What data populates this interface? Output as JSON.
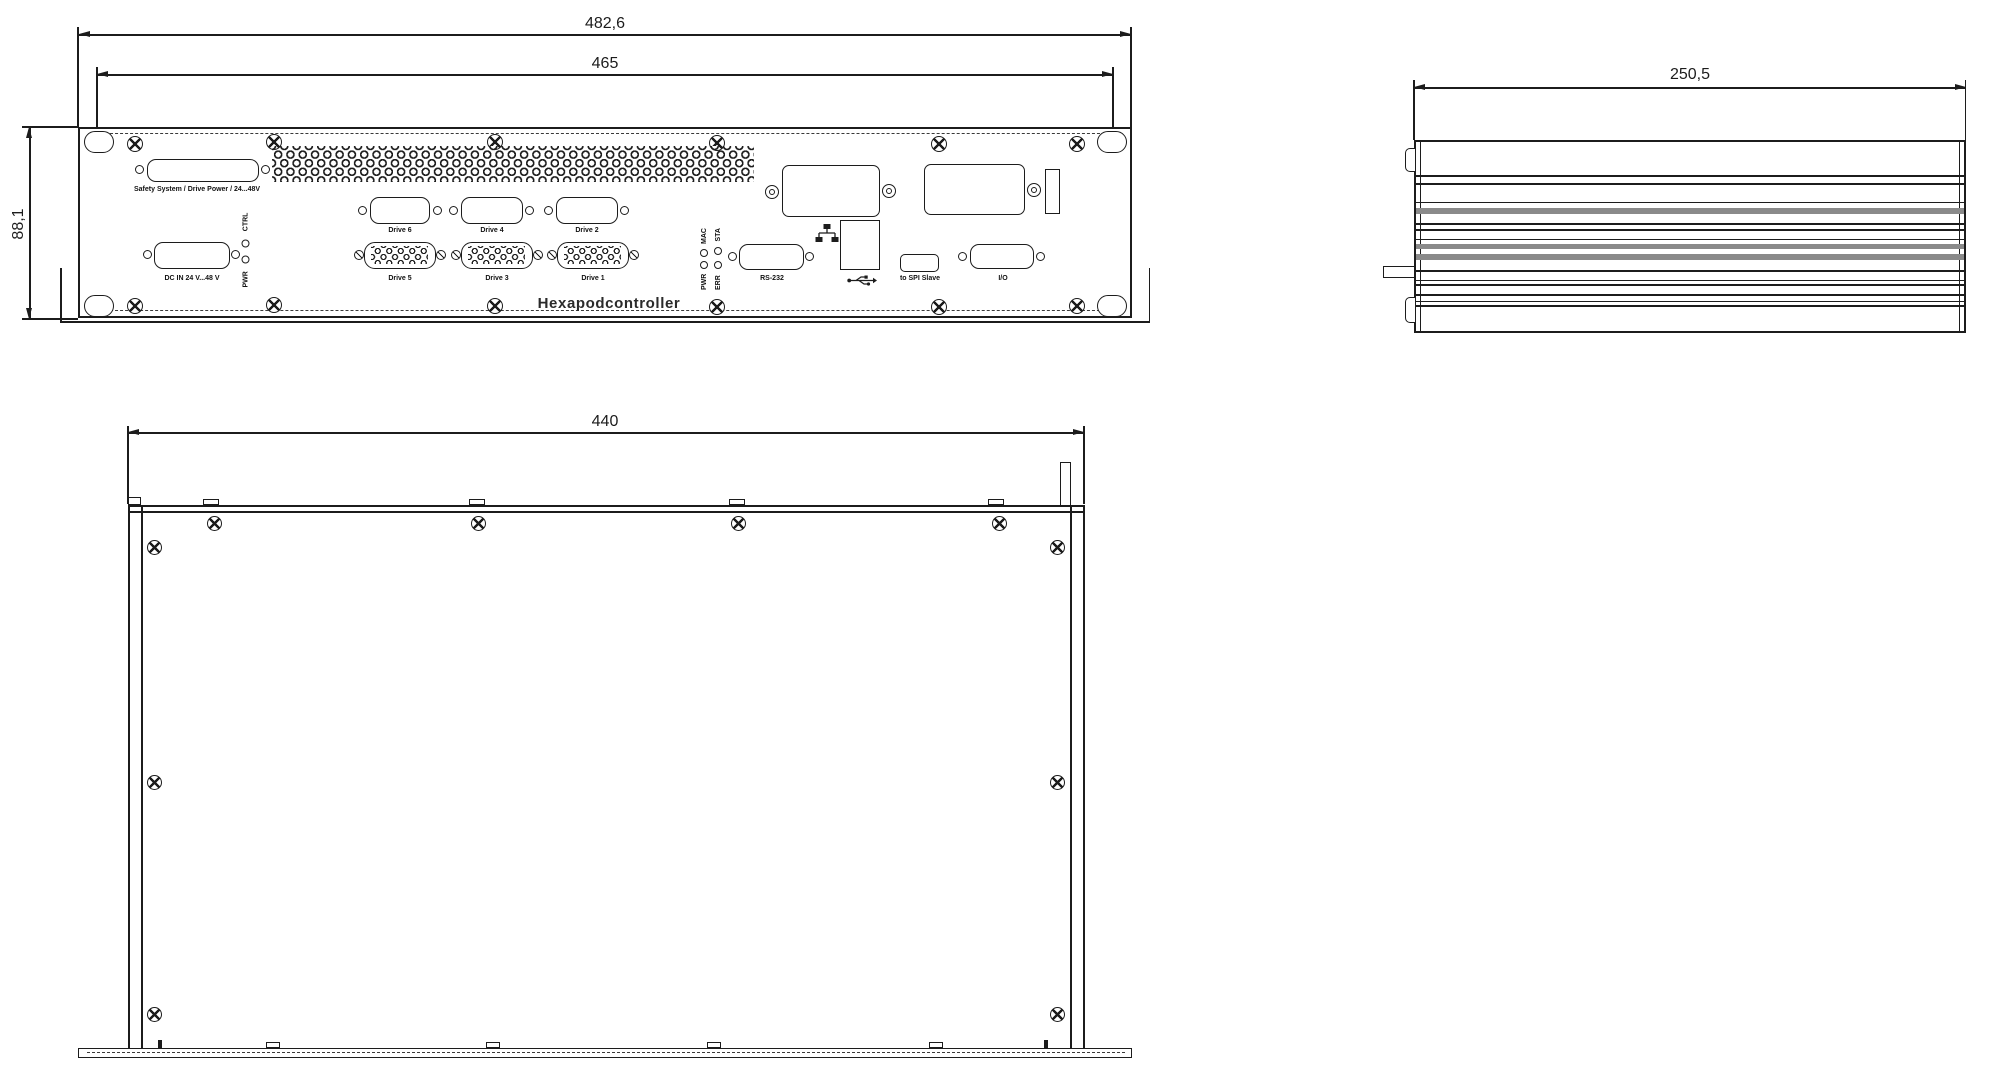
{
  "title": "Hexapodcontroller",
  "colors": {
    "line": "#1c1c1c",
    "fin_gray": "#8a8a8a"
  },
  "dimensions": {
    "front_width_outer": "482,6",
    "front_width_inner": "465",
    "front_height": "88,1",
    "side_depth": "250,5",
    "top_width": "440"
  },
  "front_panel": {
    "safety_label": "Safety System / Drive Power / 24...48V",
    "dc_in_label": "DC IN 24 V...48 V",
    "led_group1": {
      "bottom": "PWR",
      "top": "CTRL"
    },
    "led_group2": {
      "col1_bottom": "PWR",
      "col1_top": "MAC",
      "col2_bottom": "ERR",
      "col2_top": "STA"
    },
    "drives_top": [
      {
        "label": "Drive 6"
      },
      {
        "label": "Drive 4"
      },
      {
        "label": "Drive 2"
      }
    ],
    "drives_bottom": [
      {
        "label": "Drive 5"
      },
      {
        "label": "Drive 3"
      },
      {
        "label": "Drive 1"
      }
    ],
    "rs232_label": "RS-232",
    "spi_label": "to SPI Slave",
    "io_label": "I/O"
  }
}
